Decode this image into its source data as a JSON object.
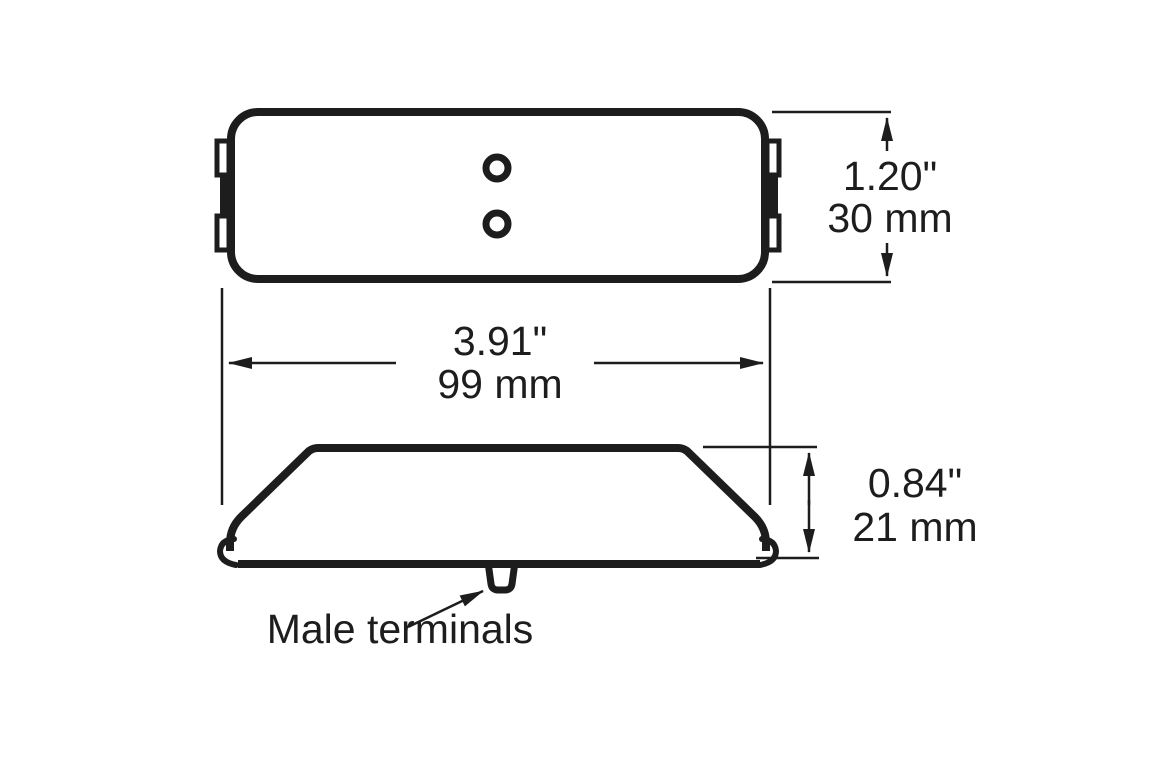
{
  "drawing": {
    "ink_color": "#1d1d1d",
    "background_color": "#ffffff",
    "dim_height_top": {
      "inches": "1.20\"",
      "metric": "30 mm"
    },
    "dim_width": {
      "inches": "3.91\"",
      "metric": "99 mm"
    },
    "dim_height_side": {
      "inches": "0.84\"",
      "metric": "21 mm"
    },
    "terminal_label": "Male terminals"
  }
}
